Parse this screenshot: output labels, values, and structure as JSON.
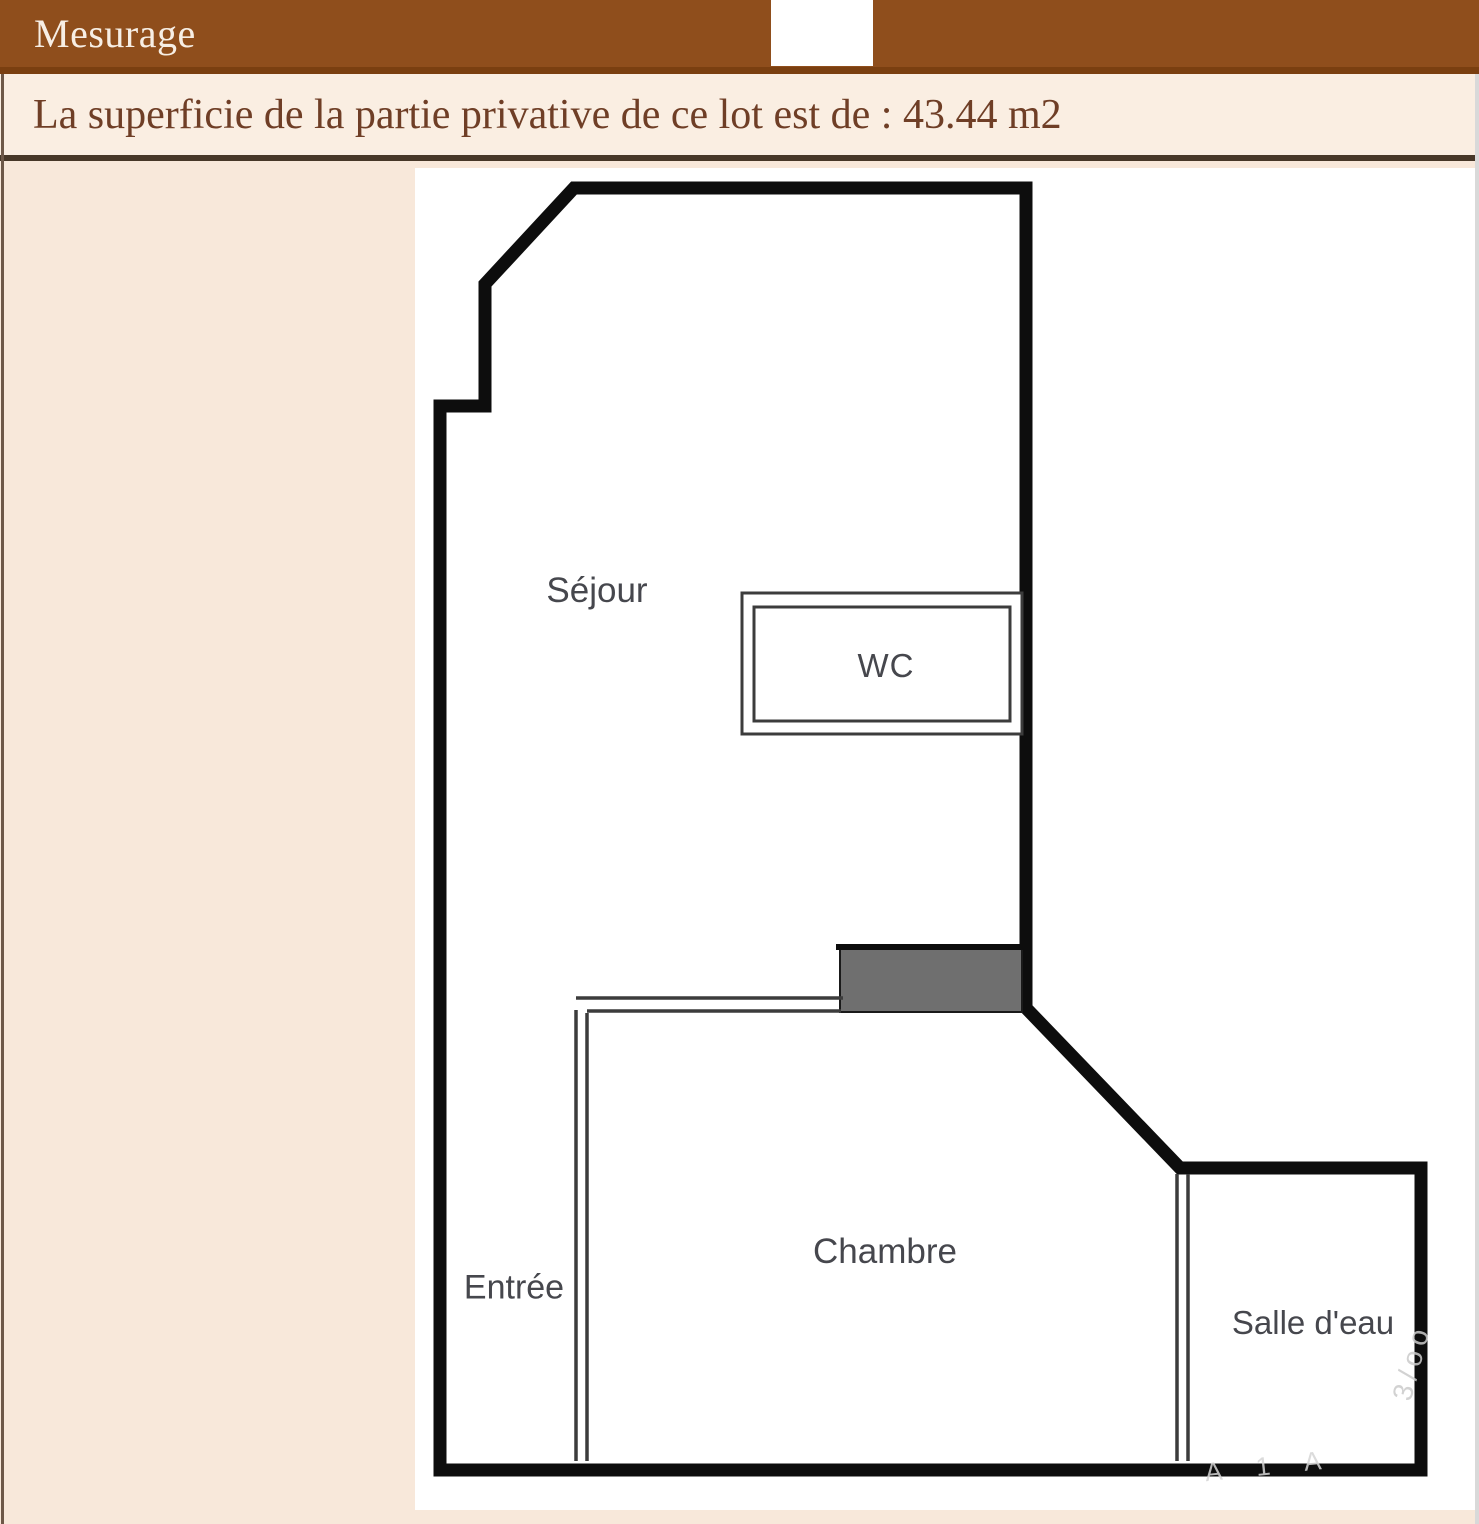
{
  "header": {
    "title": "Mesurage"
  },
  "banner": {
    "text": "La superficie de la partie privative de ce lot est de : 43.44 m2",
    "area_value": "43.44 m2"
  },
  "floorplan": {
    "rooms": [
      {
        "id": "sejour",
        "label": "Séjour"
      },
      {
        "id": "wc",
        "label": "WC"
      },
      {
        "id": "entree",
        "label": "Entrée"
      },
      {
        "id": "chambre",
        "label": "Chambre"
      },
      {
        "id": "salle-deau",
        "label": "Salle d'eau"
      }
    ],
    "watermark": [
      {
        "text": "3/oo"
      },
      {
        "text": "A 1 A"
      }
    ]
  },
  "colors": {
    "header_bg": "#8F4E1C",
    "header_divider": "#7A3F10",
    "header_text": "#F7EEE4",
    "banner_bg": "#FAEEE2",
    "banner_text": "#6F3E26",
    "banner_border": "#473728",
    "panel_bg": "#F8E8DA",
    "plan_bg": "#FFFFFF",
    "wall": "#0D0D0D",
    "thin_line": "#3C3C3C",
    "duct_block": "#6F6F6F",
    "room_label_text": "#46474D"
  }
}
